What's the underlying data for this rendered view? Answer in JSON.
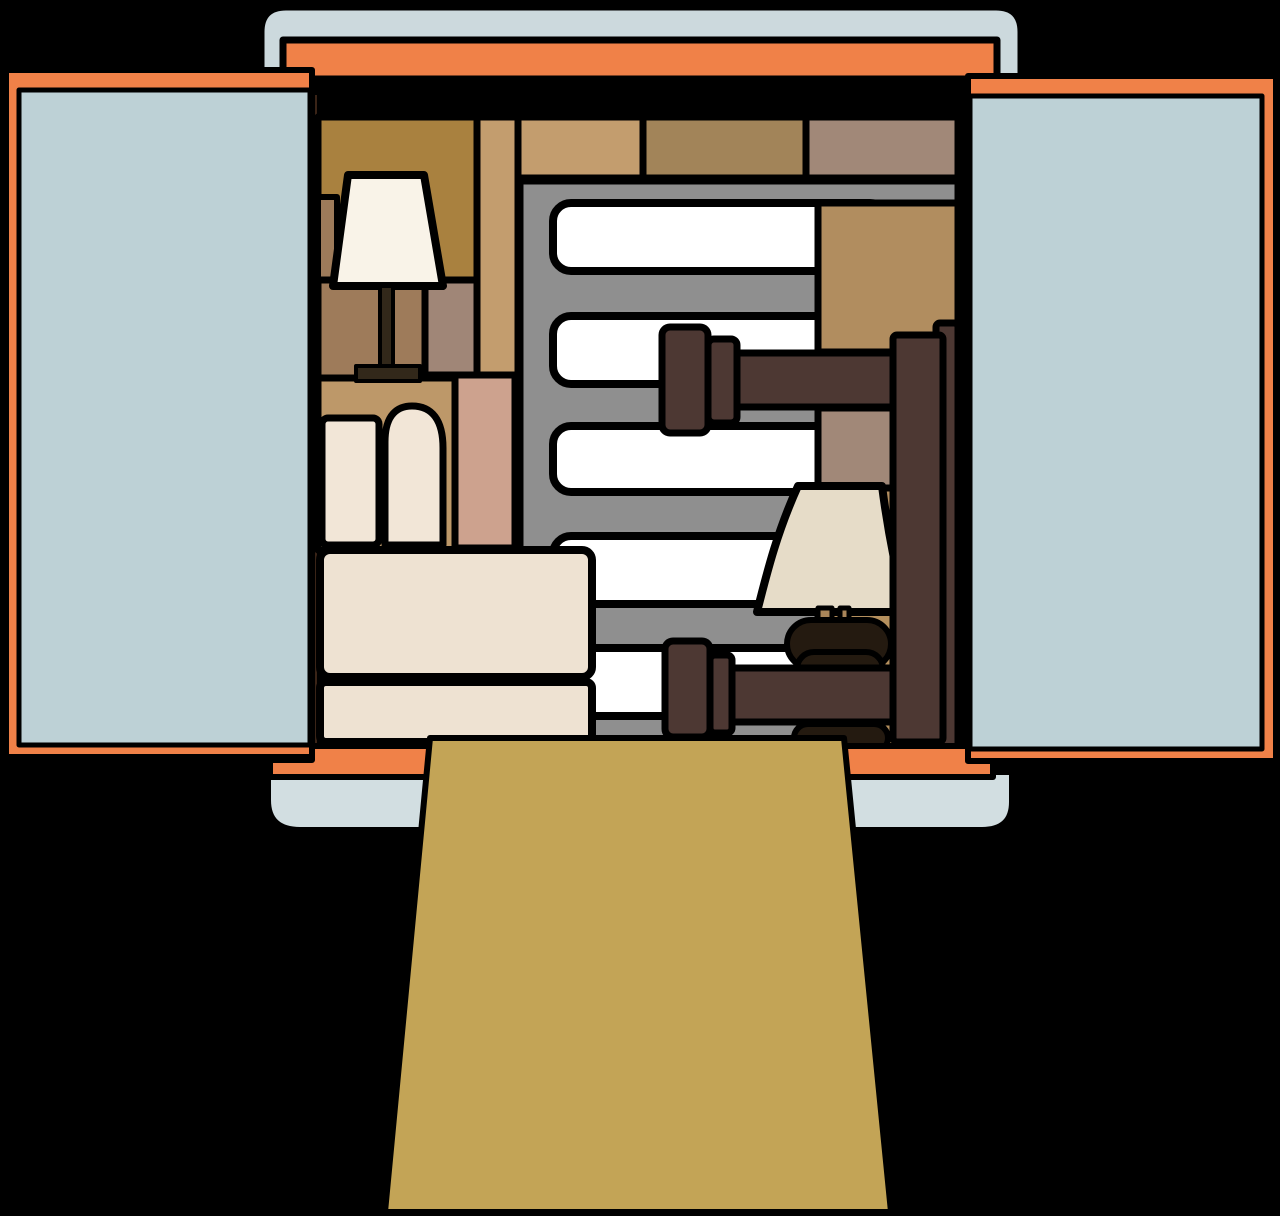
{
  "illustration": {
    "kind": "vector-clipart",
    "subject": "moving-truck-rear-open-doors-packed-with-furniture",
    "objects": [
      "truck-roof",
      "header-bar",
      "left-door",
      "right-door",
      "cardboard-boxes",
      "floor-lamp",
      "slat-rack",
      "sofa",
      "bed-frame",
      "table-lamp",
      "floor-edge",
      "bumper",
      "loading-ramp"
    ]
  },
  "palette": {
    "background": "#000000",
    "truck_body_blue": "#ccd9dd",
    "door_panel_blue": "#bdd1d6",
    "bumper_blue": "#d2dee1",
    "orange": "#f08148",
    "ramp_olive": "#c3a456",
    "box_golden_brown": "#a9813f",
    "box_tan": "#c39d6e",
    "box_brown": "#a28459",
    "box_mauve": "#a18878",
    "box_mauve_dark": "#a08677",
    "box_medium_brown": "#9e7b5a",
    "box_pink": "#cda28e",
    "box_tan_light": "#bd9869",
    "box_tan_big": "#b18d5f",
    "box_tan_lower": "#b5905e",
    "rack_gray": "#8f8f8f",
    "slot_white": "#ffffff",
    "sofa_cream": "#eee2d2",
    "cushion_cream": "#f2e6d7",
    "floorlamp_shade": "#f9f3e8",
    "tablelamp_shade": "#e6dcc8",
    "lamp_dark": "#32281a",
    "lamp_base_dark": "#241a10",
    "lamp_prong_tan": "#a98559",
    "bed_brown": "#4d3833",
    "door_edge_brown": "#3a2417"
  }
}
